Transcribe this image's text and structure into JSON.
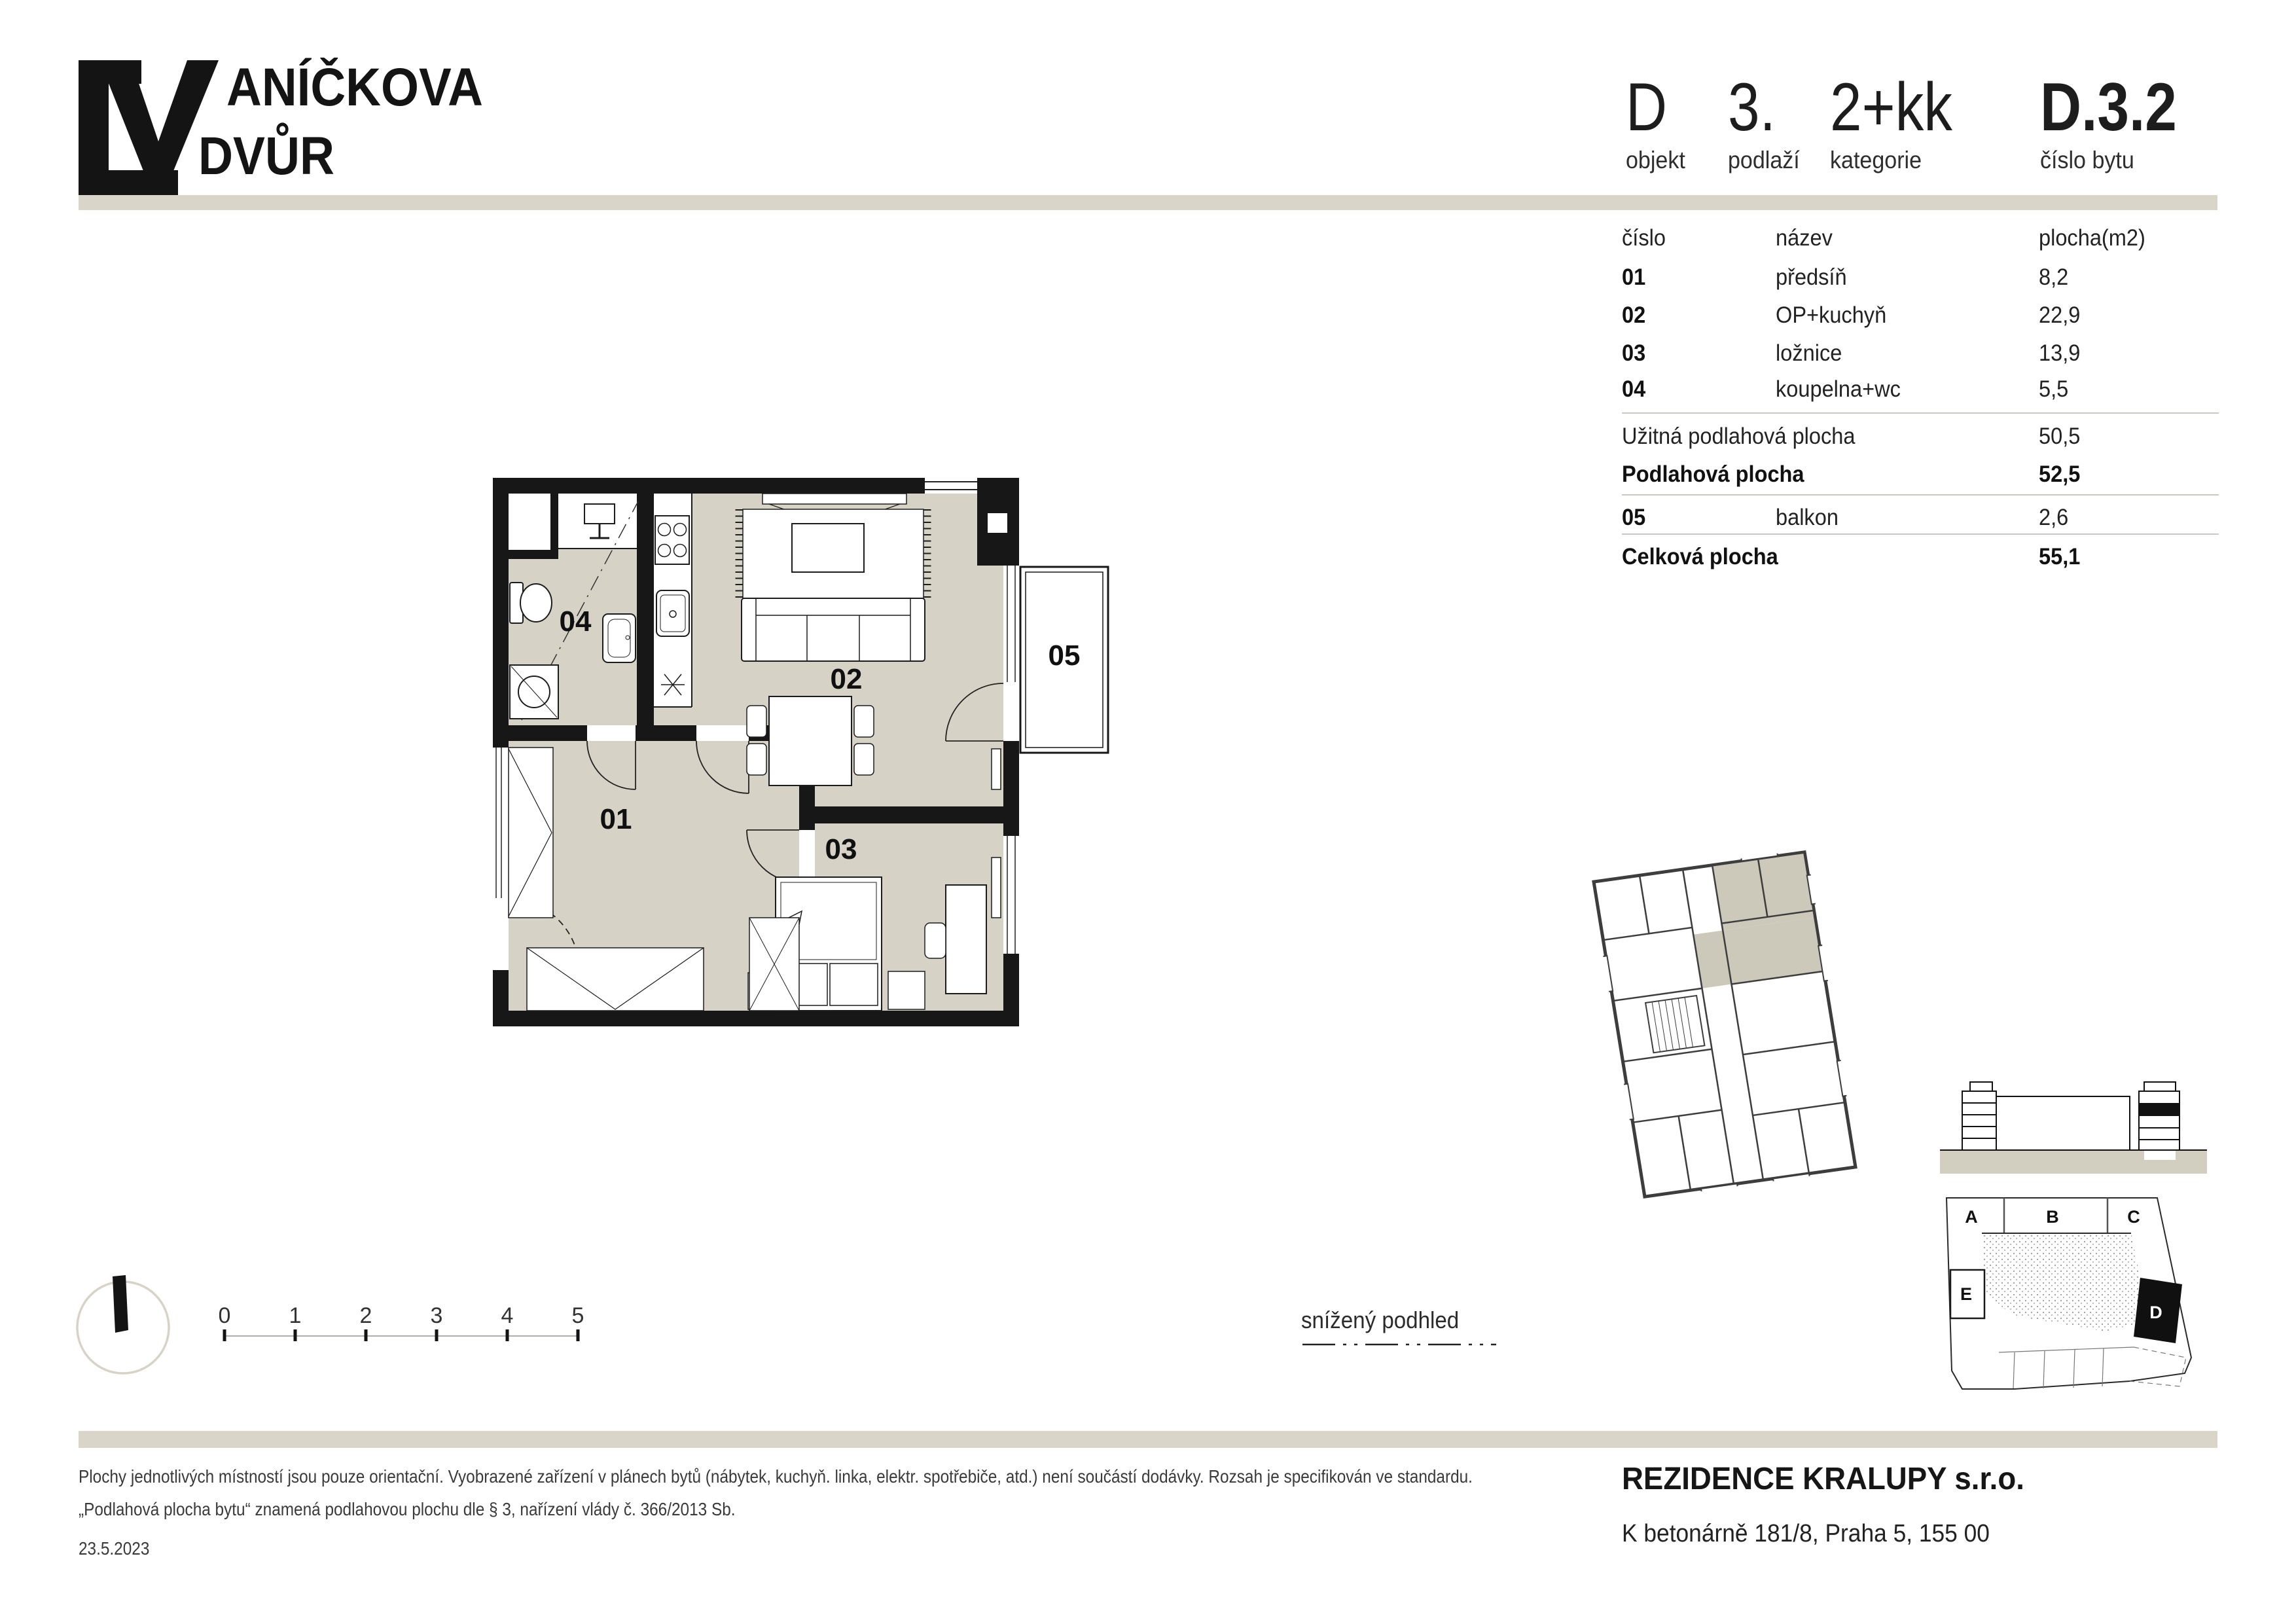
{
  "logo": {
    "big_letter": "V",
    "word_top": "ANÍČKOVA",
    "word_bottom": "DVŮR"
  },
  "header": {
    "fields": [
      {
        "value": "D",
        "label": "objekt"
      },
      {
        "value": "3.",
        "label": "podlaží"
      },
      {
        "value": "2+kk",
        "label": "kategorie"
      }
    ],
    "unit": {
      "value": "D.3.2",
      "label": "číslo bytu"
    }
  },
  "table": {
    "headers": {
      "number": "číslo",
      "name": "název",
      "area": "plocha(m2)"
    },
    "rows": [
      {
        "number": "01",
        "name": "předsíň",
        "area": "8,2"
      },
      {
        "number": "02",
        "name": "OP+kuchyň",
        "area": "22,9"
      },
      {
        "number": "03",
        "name": "ložnice",
        "area": "13,9"
      },
      {
        "number": "04",
        "name": "koupelna+wc",
        "area": "5,5"
      }
    ],
    "usable": {
      "label": "Užitná podlahová plocha",
      "value": "50,5"
    },
    "floor": {
      "label": "Podlahová plocha",
      "value": "52,5"
    },
    "balcony": {
      "number": "05",
      "name": "balkon",
      "area": "2,6"
    },
    "total": {
      "label": "Celková plocha",
      "value": "55,1"
    }
  },
  "plan": {
    "rooms": {
      "r01": "01",
      "r02": "02",
      "r03": "03",
      "r04": "04",
      "r05": "05"
    }
  },
  "legend": {
    "lowered_ceiling": "snížený podhled"
  },
  "scalebar": {
    "ticks": [
      "0",
      "1",
      "2",
      "3",
      "4",
      "5"
    ]
  },
  "siteplan": {
    "blocks": {
      "a": "A",
      "b": "B",
      "c": "C",
      "e": "E",
      "d": "D"
    }
  },
  "footer": {
    "disclaimer_line1": "Plochy jednotlivých místností jsou pouze orientační. Vyobrazené zařízení v plánech bytů (nábytek, kuchyň. linka, elektr. spotřebiče, atd.) není součástí dodávky. Rozsah je specifikován ve standardu.",
    "disclaimer_line2": "„Podlahová plocha bytu“ znamená podlahovou plochu dle § 3, nařízení vlády č. 366/2013 Sb.",
    "date": "23.5.2023",
    "company": "REZIDENCE KRALUPY s.r.o.",
    "address": "K betonárně 181/8, Praha 5, 155 00"
  },
  "colors": {
    "accent_beige": "#d9d6c9",
    "floor": "#d6d3c6",
    "wall": "#171717",
    "highlight": "#111111"
  }
}
